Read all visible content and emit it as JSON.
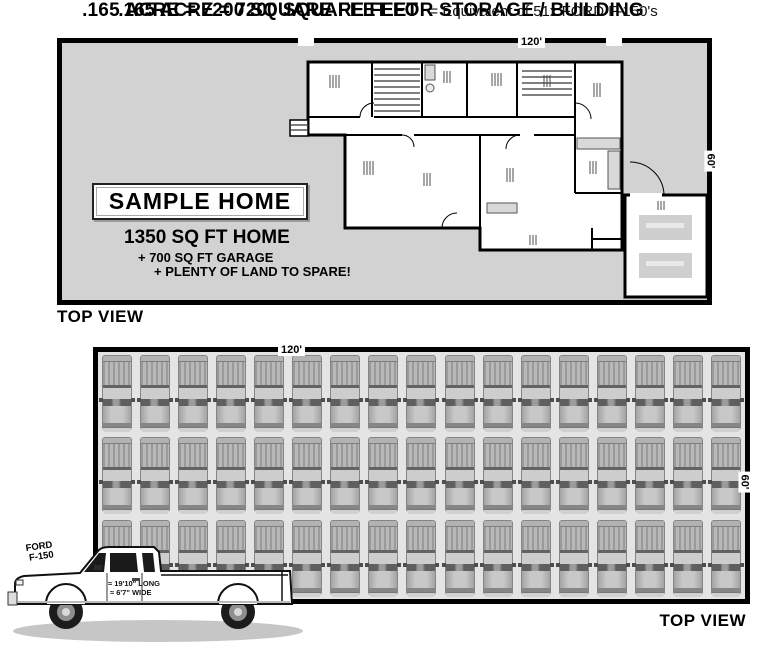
{
  "colors": {
    "lot_fill": "#d2d2d2",
    "truck_lane": "#e4e4e4",
    "line": "#000000"
  },
  "top_section": {
    "title": ".165 ACRE = 7200 SQUARE FEET FOR STORAGE / BUILDING",
    "lot": {
      "width_label": "120'",
      "height_label": "60'"
    },
    "sample_home_label": "SAMPLE HOME",
    "stats": [
      "1350 SQ FT HOME",
      "+ 700 SQ FT GARAGE",
      "+ PLENTY OF LAND TO SPARE!"
    ],
    "view_label": "TOP VIEW"
  },
  "bottom_section": {
    "title_bold": ".165 ACRE = 7200 SQUARE FEET",
    "title_rest": "= Equivalent of 51x FORD F-150's",
    "lot": {
      "width_label": "120'",
      "height_label": "60'"
    },
    "truck_grid": {
      "rows": 3,
      "columns": 17,
      "total_trucks": 51
    },
    "truck_callout": {
      "name_line1": "FORD",
      "name_line2": "F-150",
      "door_line1": "≈ 19'10\" LONG",
      "door_line2": "≈ 6'7\" WIDE"
    },
    "view_label": "TOP VIEW"
  }
}
